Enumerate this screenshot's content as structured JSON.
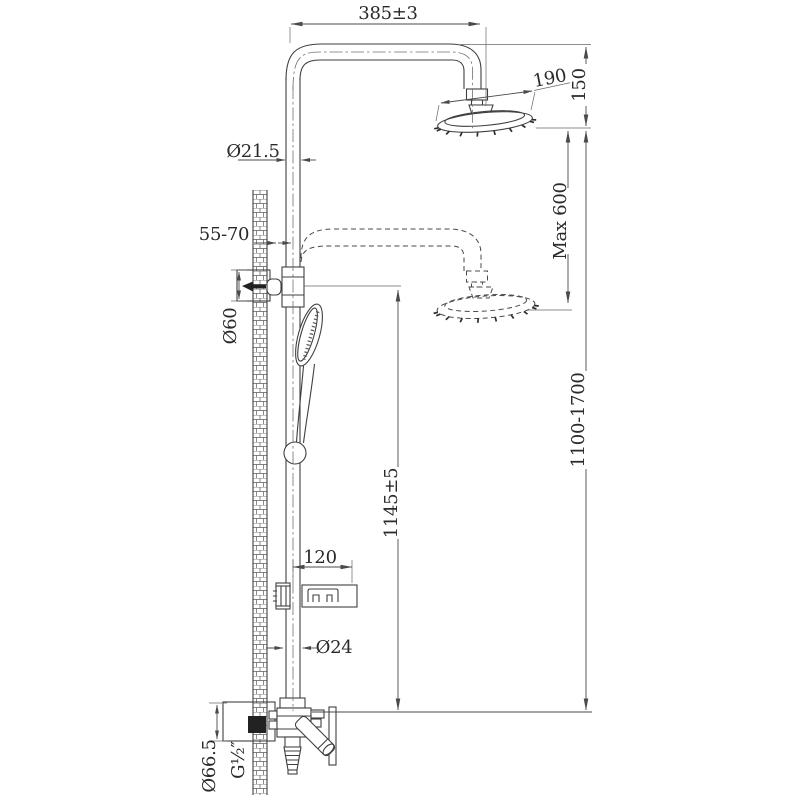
{
  "page": {
    "background": "#ffffff",
    "line_color": "#3f3f3f",
    "text_color": "#2a2a2a"
  },
  "drawing": {
    "subject": "shower-column-installation-drawing",
    "type": "technical line drawing with dimensions",
    "dimensions": {
      "arm_width": "385±3",
      "head_diameter": "190",
      "head_height": "150",
      "riser_diameter": "Ø21.5",
      "max_extension": "Max 600",
      "wall_offset": "55-70",
      "bracket_diameter": "Ø60",
      "overall_height": "1100-1700",
      "bracket_height": "1145±5",
      "soap_dish_width": "120",
      "lower_tube_diameter": "Ø24",
      "escutcheon_diameter": "Ø66.5",
      "inlet_thread": "G½″"
    }
  }
}
